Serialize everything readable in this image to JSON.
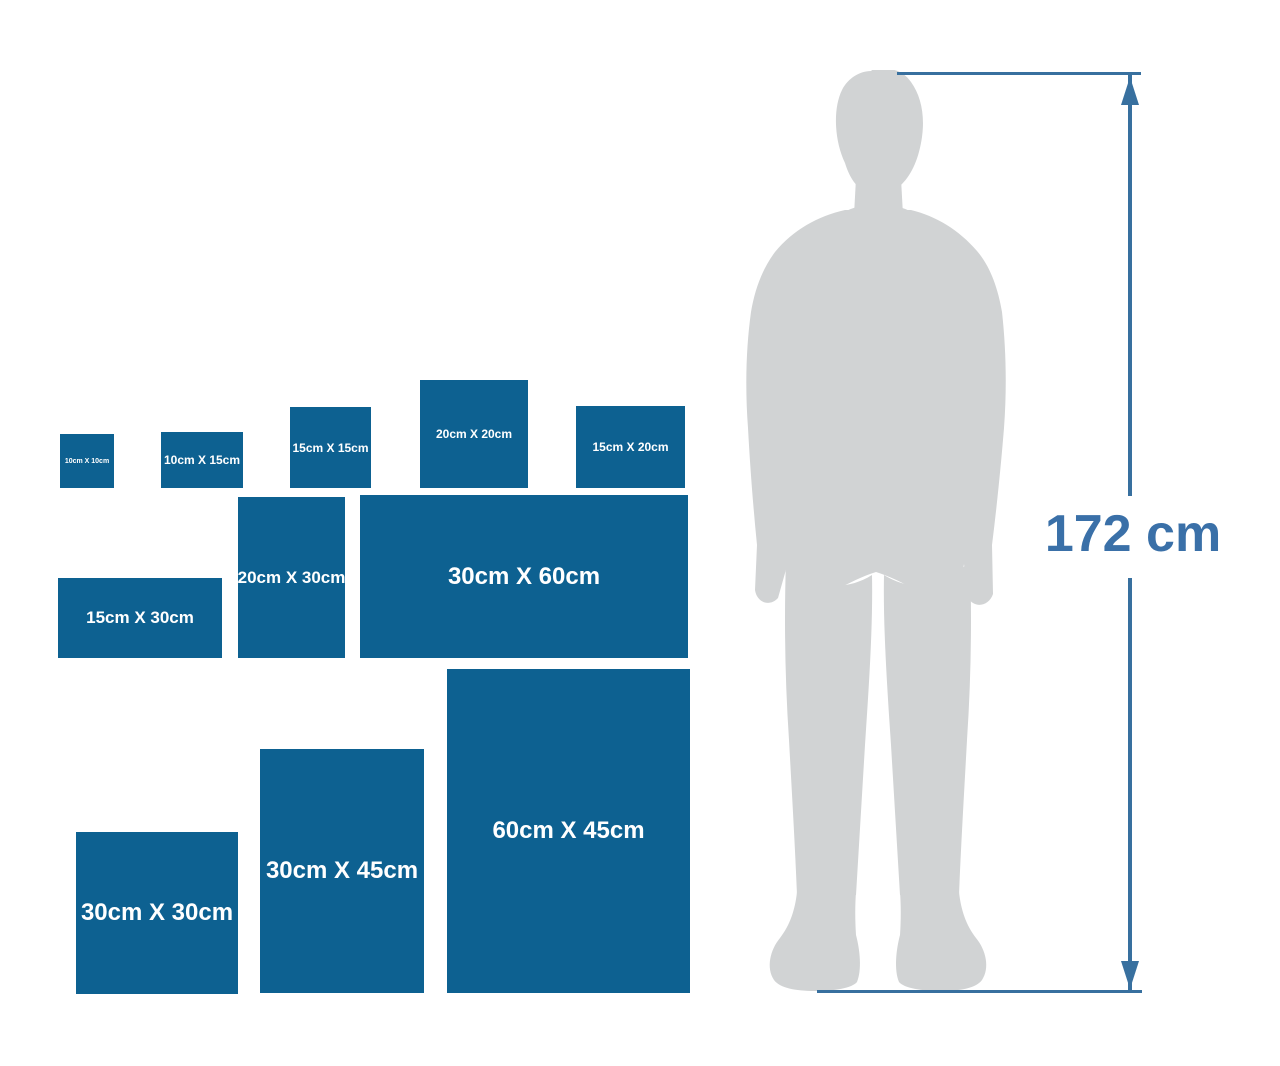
{
  "colors": {
    "background": "#ffffff",
    "box_blue": "#0d6191",
    "label_white": "#ffffff",
    "silhouette_gray": "#d1d3d4",
    "dimension_blue": "#38709f",
    "dimension_text_blue": "#3a70a8"
  },
  "sizes": [
    {
      "id": "10x10",
      "label": "10cm X 10cm",
      "width_cm": 10,
      "height_cm": 10,
      "x": 60,
      "y": 434,
      "w": 54,
      "h": 54,
      "font": 7
    },
    {
      "id": "10x15",
      "label": "10cm X 15cm",
      "width_cm": 15,
      "height_cm": 10,
      "x": 161,
      "y": 432,
      "w": 82,
      "h": 56,
      "font": 12
    },
    {
      "id": "15x15",
      "label": "15cm X 15cm",
      "width_cm": 15,
      "height_cm": 15,
      "x": 290,
      "y": 407,
      "w": 81,
      "h": 81,
      "font": 12
    },
    {
      "id": "20x20",
      "label": "20cm X 20cm",
      "width_cm": 20,
      "height_cm": 20,
      "x": 420,
      "y": 380,
      "w": 108,
      "h": 108,
      "font": 12
    },
    {
      "id": "15x20",
      "label": "15cm X 20cm",
      "width_cm": 20,
      "height_cm": 15,
      "x": 576,
      "y": 406,
      "w": 109,
      "h": 82,
      "font": 12
    },
    {
      "id": "15x30",
      "label": "15cm X 30cm",
      "width_cm": 30,
      "height_cm": 15,
      "x": 58,
      "y": 578,
      "w": 164,
      "h": 80,
      "font": 17
    },
    {
      "id": "20x30",
      "label": "20cm X 30cm",
      "width_cm": 20,
      "height_cm": 30,
      "x": 238,
      "y": 497,
      "w": 107,
      "h": 161,
      "font": 17
    },
    {
      "id": "30x60",
      "label": "30cm X 60cm",
      "width_cm": 60,
      "height_cm": 30,
      "x": 360,
      "y": 495,
      "w": 328,
      "h": 163,
      "font": 24
    },
    {
      "id": "30x30",
      "label": "30cm X 30cm",
      "width_cm": 30,
      "height_cm": 30,
      "x": 76,
      "y": 832,
      "w": 162,
      "h": 162,
      "font": 24
    },
    {
      "id": "30x45",
      "label": "30cm X 45cm",
      "width_cm": 30,
      "height_cm": 45,
      "x": 260,
      "y": 749,
      "w": 164,
      "h": 244,
      "font": 24
    },
    {
      "id": "60x45",
      "label": "60cm X 45cm",
      "width_cm": 45,
      "height_cm": 60,
      "x": 447,
      "y": 669,
      "w": 243,
      "h": 324,
      "font": 24
    }
  ],
  "dimension": {
    "height_label": "172 cm"
  }
}
